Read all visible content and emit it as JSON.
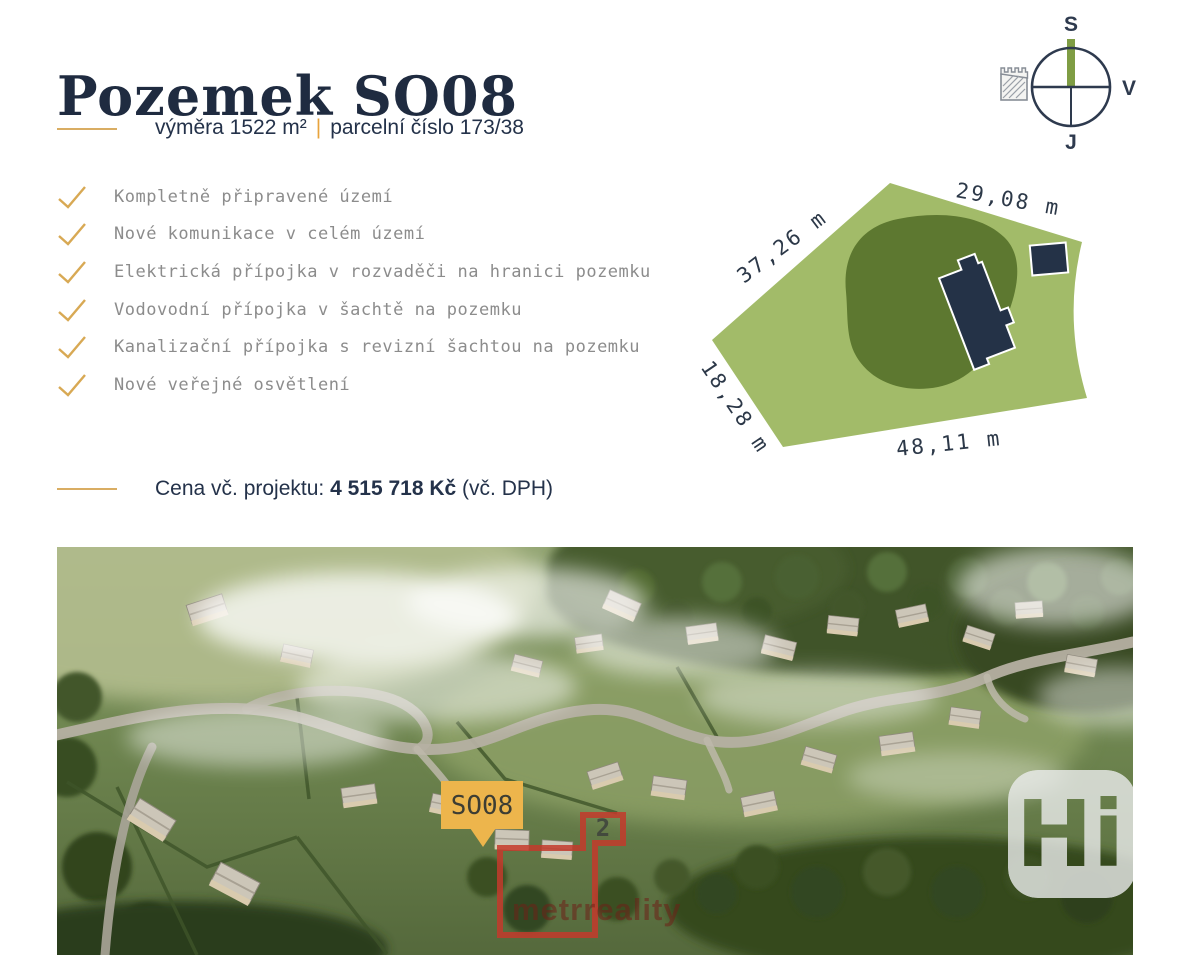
{
  "header": {
    "title": "Pozemek SO08"
  },
  "subtitle": {
    "area": "výměra 1522 m²",
    "separator": "|",
    "parcel": "parcelní číslo 173/38"
  },
  "features": {
    "items": [
      "Kompletně připravené území",
      "Nové komunikace v celém území",
      "Elektrická přípojka v rozvaděči na hranici pozemku",
      "Vodovodní přípojka v šachtě na pozemku",
      "Kanalizační přípojka s revizní šachtou na pozemku",
      "Nové veřejné osvětlení"
    ]
  },
  "price": {
    "prefix": "Cena vč. projektu: ",
    "amount": "4 515 718 Kč",
    "suffix": " (vč. DPH)"
  },
  "compass": {
    "north": "S",
    "east": "V",
    "south": "J"
  },
  "plot": {
    "dimensions": {
      "top": "29,08 m",
      "left": "37,26 m",
      "bottom_left": "18,28 m",
      "bottom": "48,11 m"
    }
  },
  "photo": {
    "marker": "SO08",
    "zone_number": "2",
    "watermark": "metrreality",
    "logo": "Hi"
  },
  "colors": {
    "accent_gold": "#d9ad63",
    "check_gold": "#d8a954",
    "navy": "#24324a",
    "plot_light_green": "#a2bb69",
    "plot_dark_green": "#5d7830",
    "red_outline": "#c33a2c",
    "marker_yellow": "#edb54c"
  }
}
